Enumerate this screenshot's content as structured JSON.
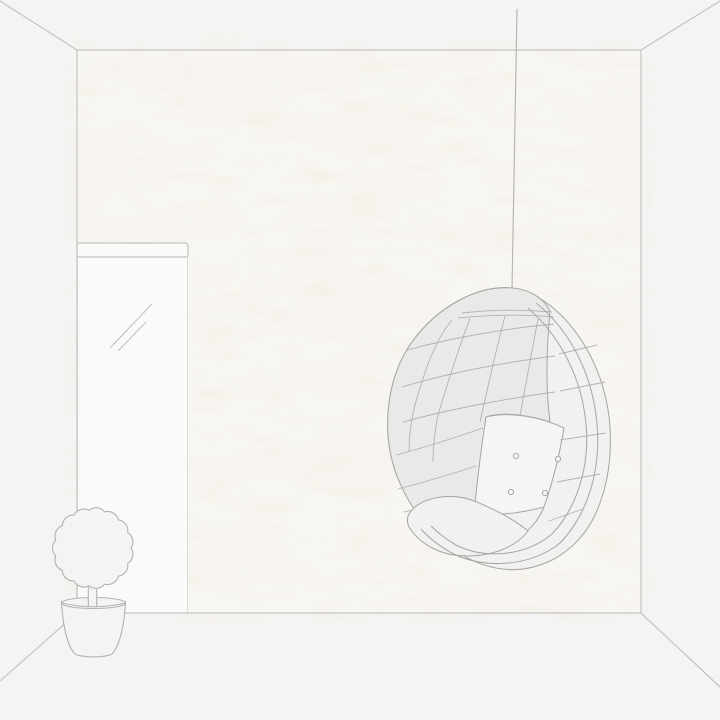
{
  "scene": {
    "name": "room-wallpaper-mockup",
    "objects": {
      "wallpaper_panel": "textured-plaster-wallpaper",
      "mirror": "full-length-mirror",
      "plant": "potted-topiary-plant",
      "chair": "hanging-egg-chair"
    }
  },
  "colors": {
    "bg": "#f4f4f3",
    "room_line": "#c5c4c2",
    "paper_base": "#f8f6f1",
    "paper_blotch": "#e7dfd0",
    "object_line": "#b3b2b0",
    "chair_line": "#a8a8a6",
    "chair_shell": "#e9e9e8",
    "chair_rim": "#f1f1f0",
    "chair_cushion": "#f5f5f4",
    "mirror_glass": "#fafaf9",
    "button_fill": "#f7f7f6"
  }
}
